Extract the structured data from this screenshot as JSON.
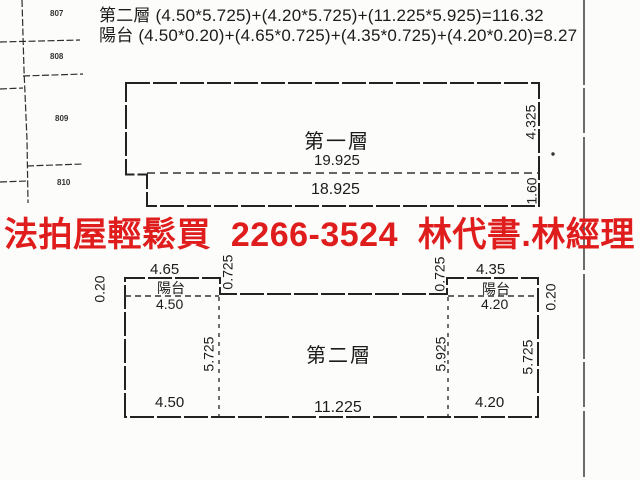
{
  "document": {
    "kind": "scanned floor plan sketch with advertisement overlay",
    "ink_color": "#1c1c1c",
    "paper_color": "#fcfcfa"
  },
  "formulas": {
    "line1": "第二層 (4.50*5.725)+(4.20*5.725)+(11.225*5.925)=116.32",
    "line2": "陽台 (4.50*0.20)+(4.65*0.725)+(4.35*0.725)+(4.20*0.20)=8.27"
  },
  "banner": {
    "text": "法拍屋輕鬆買  2266-3524  林代書.林經理",
    "phone": "2266-3524",
    "color": "#e01d1d"
  },
  "parcels": [
    "807",
    "808",
    "809",
    "810"
  ],
  "floor1": {
    "label": "第一層",
    "upper_width": "19.925",
    "lower_width": "18.925",
    "right_height_upper": "4.325",
    "right_height_lower": "1.60"
  },
  "floor2": {
    "label": "第二層",
    "balcony_left": {
      "label": "陽台",
      "outer_width": "4.65",
      "inner_width": "4.50",
      "depth": "0.725",
      "side": "0.20"
    },
    "balcony_right": {
      "label": "陽台",
      "outer_width": "4.35",
      "inner_width": "4.20",
      "depth": "0.725",
      "side": "0.20"
    },
    "left_height": "5.725",
    "mid_height": "5.925",
    "right_height": "5.725",
    "bottom_left_width": "4.50",
    "bottom_mid_width": "11.225",
    "bottom_right_width": "4.20"
  }
}
